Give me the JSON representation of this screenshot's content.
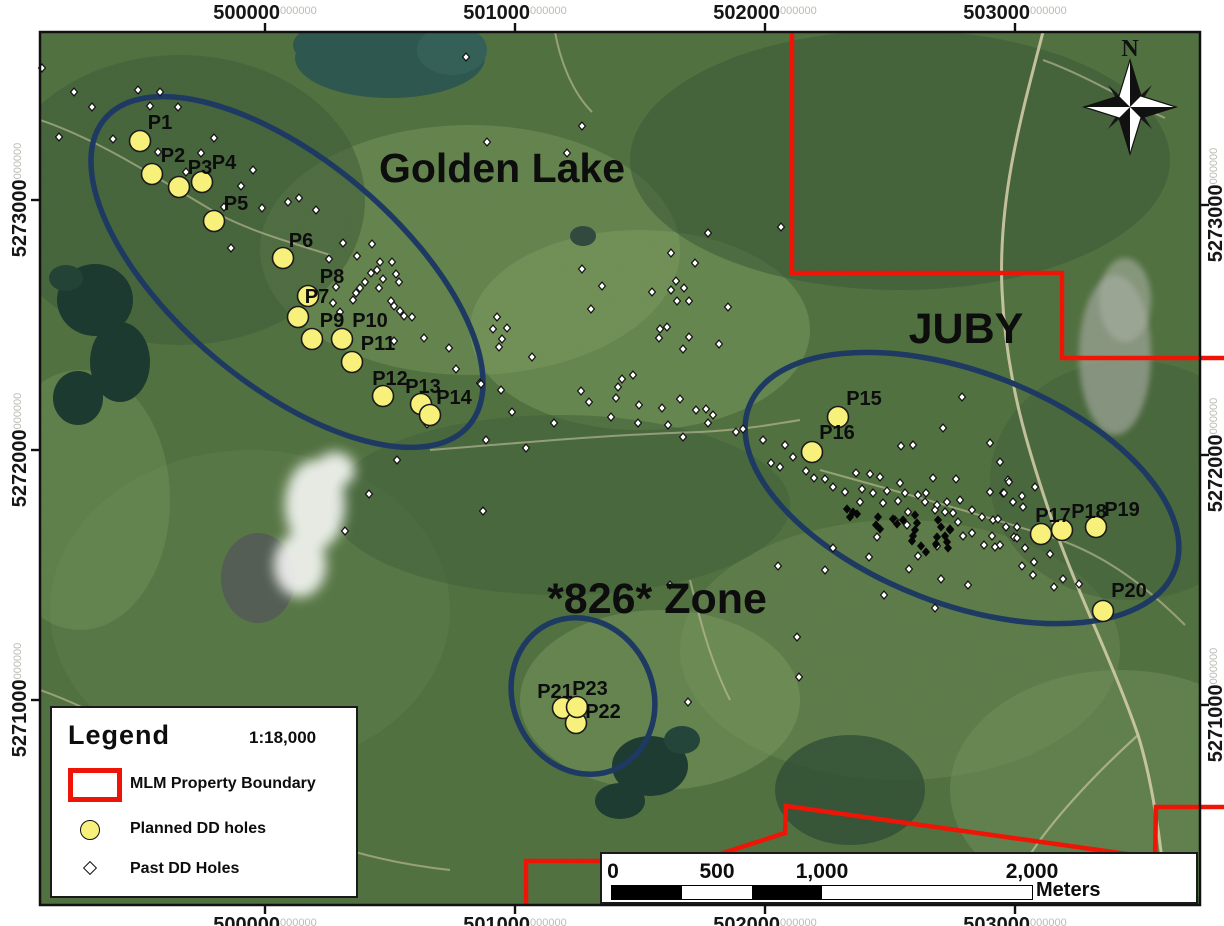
{
  "colors": {
    "boundary_red": "#ee1506",
    "zone_ellipse": "#1e3a62",
    "planned_fill": "#f7f07b",
    "past_fill": "#ffffff",
    "grid_suffix_gray": "#b7bdb2",
    "label_black": "#0d0d0d"
  },
  "north": {
    "label": "N"
  },
  "legend": {
    "title": "Legend",
    "scale": "1:18,000",
    "items": [
      {
        "label": "MLM Property Boundary",
        "type": "boundary"
      },
      {
        "label": "Planned DD holes",
        "type": "planned"
      },
      {
        "label": "Past DD Holes",
        "type": "past"
      }
    ]
  },
  "scalebar": {
    "labels": [
      {
        "t": "0",
        "x": 11
      },
      {
        "t": "500",
        "x": 115
      },
      {
        "t": "1,000",
        "x": 220
      },
      {
        "t": "2,000",
        "x": 430
      }
    ],
    "unit": "Meters",
    "segment_widths": [
      70,
      70,
      70,
      210
    ],
    "segment_colors": [
      "#000000",
      "#ffffff",
      "#000000",
      "#ffffff"
    ]
  },
  "grid": {
    "suffix": "000000",
    "top": [
      {
        "label": "500000",
        "x": 265
      },
      {
        "label": "501000",
        "x": 515
      },
      {
        "label": "502000",
        "x": 765
      },
      {
        "label": "503000",
        "x": 1015
      }
    ],
    "bottom": [
      {
        "label": "500000",
        "x": 265
      },
      {
        "label": "501000",
        "x": 515
      },
      {
        "label": "502000",
        "x": 765
      },
      {
        "label": "503000",
        "x": 1015
      }
    ],
    "left": [
      {
        "label": "5273000",
        "y": 200
      },
      {
        "label": "5272000",
        "y": 450
      },
      {
        "label": "5271000",
        "y": 700
      }
    ],
    "right": [
      {
        "label": "5273000",
        "y": 205
      },
      {
        "label": "5272000",
        "y": 455
      },
      {
        "label": "5271000",
        "y": 705
      }
    ]
  },
  "zones": [
    {
      "name": "Golden Lake",
      "x": 502,
      "y": 182,
      "size": 41,
      "cx": 287,
      "cy": 272,
      "rx": 238,
      "ry": 112,
      "rot": 40
    },
    {
      "name": "JUBY",
      "x": 966,
      "y": 343,
      "size": 43,
      "cx": 962,
      "cy": 488,
      "rx": 228,
      "ry": 116,
      "rot": 21
    },
    {
      "name": "*826* Zone",
      "x": 657,
      "y": 613,
      "size": 43,
      "cx": 583,
      "cy": 696,
      "rx": 70,
      "ry": 80,
      "rot": -25
    }
  ],
  "boundary_paths": [
    "M 792 32 L 792 273 L 1062 273 L 1062 358 L 1224 358",
    "M 526 905 L 526 861 L 698 861 L 785 833 L 786 806 L 1155 858 L 1156 807 L 1224 807"
  ],
  "planned_holes": [
    {
      "id": "P1",
      "x": 140,
      "y": 141,
      "lx": 160,
      "ly": 122
    },
    {
      "id": "P2",
      "x": 152,
      "y": 174,
      "lx": 173,
      "ly": 155
    },
    {
      "id": "P3",
      "x": 179,
      "y": 187,
      "lx": 200,
      "ly": 167
    },
    {
      "id": "P4",
      "x": 202,
      "y": 182,
      "lx": 224,
      "ly": 162
    },
    {
      "id": "P5",
      "x": 214,
      "y": 221,
      "lx": 236,
      "ly": 203
    },
    {
      "id": "P6",
      "x": 283,
      "y": 258,
      "lx": 301,
      "ly": 240
    },
    {
      "id": "P7",
      "x": 308,
      "y": 296,
      "lx": 317,
      "ly": 296
    },
    {
      "id": "P8",
      "x": 298,
      "y": 317,
      "lx": 332,
      "ly": 276
    },
    {
      "id": "P9",
      "x": 312,
      "y": 339,
      "lx": 332,
      "ly": 320
    },
    {
      "id": "P10",
      "x": 342,
      "y": 339,
      "lx": 370,
      "ly": 320
    },
    {
      "id": "P11",
      "x": 352,
      "y": 362,
      "lx": 378,
      "ly": 343
    },
    {
      "id": "P12",
      "x": 383,
      "y": 396,
      "lx": 390,
      "ly": 378
    },
    {
      "id": "P13",
      "x": 421,
      "y": 404,
      "lx": 423,
      "ly": 386
    },
    {
      "id": "P14",
      "x": 430,
      "y": 415,
      "lx": 454,
      "ly": 397
    },
    {
      "id": "P15",
      "x": 838,
      "y": 417,
      "lx": 864,
      "ly": 398
    },
    {
      "id": "P16",
      "x": 812,
      "y": 452,
      "lx": 837,
      "ly": 432
    },
    {
      "id": "P17",
      "x": 1041,
      "y": 534,
      "lx": 1053,
      "ly": 515
    },
    {
      "id": "P18",
      "x": 1062,
      "y": 530,
      "lx": 1089,
      "ly": 511
    },
    {
      "id": "P19",
      "x": 1096,
      "y": 527,
      "lx": 1122,
      "ly": 509
    },
    {
      "id": "P20",
      "x": 1103,
      "y": 611,
      "lx": 1129,
      "ly": 590
    },
    {
      "id": "P21",
      "x": 563,
      "y": 708,
      "lx": 555,
      "ly": 691
    },
    {
      "id": "P22",
      "x": 576,
      "y": 723,
      "lx": 603,
      "ly": 711
    },
    {
      "id": "P23",
      "x": 577,
      "y": 707,
      "lx": 590,
      "ly": 688
    }
  ],
  "past_holes_white": [
    [
      466,
      57
    ],
    [
      42,
      68
    ],
    [
      74,
      92
    ],
    [
      138,
      90
    ],
    [
      160,
      92
    ],
    [
      92,
      107
    ],
    [
      150,
      106
    ],
    [
      178,
      107
    ],
    [
      582,
      126
    ],
    [
      59,
      137
    ],
    [
      113,
      139
    ],
    [
      214,
      138
    ],
    [
      487,
      142
    ],
    [
      158,
      152
    ],
    [
      201,
      153
    ],
    [
      567,
      153
    ],
    [
      253,
      170
    ],
    [
      186,
      172
    ],
    [
      241,
      186
    ],
    [
      288,
      202
    ],
    [
      262,
      208
    ],
    [
      224,
      207
    ],
    [
      299,
      198
    ],
    [
      316,
      210
    ],
    [
      781,
      227
    ],
    [
      231,
      248
    ],
    [
      708,
      233
    ],
    [
      343,
      243
    ],
    [
      372,
      244
    ],
    [
      671,
      253
    ],
    [
      357,
      256
    ],
    [
      329,
      259
    ],
    [
      380,
      262
    ],
    [
      392,
      262
    ],
    [
      695,
      263
    ],
    [
      582,
      269
    ],
    [
      377,
      270
    ],
    [
      371,
      273
    ],
    [
      396,
      274
    ],
    [
      383,
      279
    ],
    [
      676,
      281
    ],
    [
      399,
      282
    ],
    [
      365,
      282
    ],
    [
      602,
      286
    ],
    [
      684,
      288
    ],
    [
      379,
      288
    ],
    [
      360,
      288
    ],
    [
      336,
      287
    ],
    [
      652,
      292
    ],
    [
      356,
      293
    ],
    [
      671,
      290
    ],
    [
      353,
      300
    ],
    [
      391,
      301
    ],
    [
      677,
      301
    ],
    [
      689,
      301
    ],
    [
      333,
      303
    ],
    [
      394,
      306
    ],
    [
      728,
      307
    ],
    [
      591,
      309
    ],
    [
      400,
      311
    ],
    [
      340,
      312
    ],
    [
      404,
      316
    ],
    [
      412,
      317
    ],
    [
      497,
      317
    ],
    [
      493,
      329
    ],
    [
      507,
      328
    ],
    [
      660,
      329
    ],
    [
      667,
      327
    ],
    [
      502,
      339
    ],
    [
      659,
      338
    ],
    [
      689,
      337
    ],
    [
      424,
      338
    ],
    [
      394,
      341
    ],
    [
      719,
      344
    ],
    [
      499,
      347
    ],
    [
      449,
      348
    ],
    [
      683,
      349
    ],
    [
      532,
      357
    ],
    [
      456,
      369
    ],
    [
      622,
      379
    ],
    [
      633,
      375
    ],
    [
      480,
      383
    ],
    [
      481,
      384
    ],
    [
      618,
      387
    ],
    [
      581,
      391
    ],
    [
      501,
      390
    ],
    [
      616,
      398
    ],
    [
      589,
      402
    ],
    [
      680,
      399
    ],
    [
      639,
      405
    ],
    [
      662,
      408
    ],
    [
      706,
      409
    ],
    [
      696,
      410
    ],
    [
      512,
      412
    ],
    [
      713,
      415
    ],
    [
      611,
      417
    ],
    [
      708,
      423
    ],
    [
      638,
      423
    ],
    [
      554,
      423
    ],
    [
      427,
      424
    ],
    [
      668,
      425
    ],
    [
      736,
      432
    ],
    [
      683,
      437
    ],
    [
      486,
      440
    ],
    [
      526,
      448
    ],
    [
      397,
      460
    ],
    [
      369,
      494
    ],
    [
      483,
      511
    ],
    [
      345,
      531
    ],
    [
      962,
      397
    ],
    [
      943,
      428
    ],
    [
      990,
      443
    ],
    [
      743,
      429
    ],
    [
      763,
      440
    ],
    [
      785,
      445
    ],
    [
      771,
      463
    ],
    [
      780,
      467
    ],
    [
      793,
      457
    ],
    [
      806,
      471
    ],
    [
      814,
      478
    ],
    [
      825,
      479
    ],
    [
      833,
      487
    ],
    [
      845,
      492
    ],
    [
      856,
      473
    ],
    [
      870,
      474
    ],
    [
      880,
      477
    ],
    [
      862,
      489
    ],
    [
      873,
      493
    ],
    [
      887,
      491
    ],
    [
      860,
      502
    ],
    [
      883,
      503
    ],
    [
      900,
      483
    ],
    [
      905,
      493
    ],
    [
      898,
      501
    ],
    [
      908,
      512
    ],
    [
      895,
      520
    ],
    [
      907,
      525
    ],
    [
      918,
      495
    ],
    [
      926,
      493
    ],
    [
      925,
      502
    ],
    [
      937,
      505
    ],
    [
      947,
      502
    ],
    [
      935,
      510
    ],
    [
      945,
      512
    ],
    [
      960,
      500
    ],
    [
      972,
      510
    ],
    [
      953,
      513
    ],
    [
      958,
      522
    ],
    [
      950,
      529
    ],
    [
      963,
      536
    ],
    [
      972,
      533
    ],
    [
      982,
      517
    ],
    [
      993,
      520
    ],
    [
      1003,
      493
    ],
    [
      990,
      492
    ],
    [
      1008,
      480
    ],
    [
      1000,
      462
    ],
    [
      933,
      478
    ],
    [
      956,
      479
    ],
    [
      901,
      446
    ],
    [
      913,
      445
    ],
    [
      877,
      537
    ],
    [
      833,
      548
    ],
    [
      869,
      557
    ],
    [
      918,
      556
    ],
    [
      909,
      569
    ],
    [
      937,
      546
    ],
    [
      984,
      545
    ],
    [
      1000,
      545
    ],
    [
      1014,
      537
    ],
    [
      1017,
      527
    ],
    [
      825,
      570
    ],
    [
      884,
      595
    ],
    [
      935,
      608
    ],
    [
      968,
      585
    ],
    [
      941,
      579
    ],
    [
      1009,
      482
    ],
    [
      1004,
      493
    ],
    [
      1022,
      496
    ],
    [
      1013,
      502
    ],
    [
      1023,
      507
    ],
    [
      998,
      519
    ],
    [
      1006,
      527
    ],
    [
      1017,
      538
    ],
    [
      992,
      536
    ],
    [
      995,
      547
    ],
    [
      1025,
      548
    ],
    [
      1035,
      487
    ],
    [
      1050,
      554
    ],
    [
      1034,
      562
    ],
    [
      1022,
      566
    ],
    [
      1033,
      575
    ],
    [
      1054,
      587
    ],
    [
      1063,
      579
    ],
    [
      1079,
      584
    ],
    [
      797,
      637
    ],
    [
      670,
      585
    ],
    [
      778,
      566
    ],
    [
      799,
      677
    ],
    [
      688,
      702
    ]
  ],
  "past_holes_black": [
    [
      847,
      509
    ],
    [
      853,
      512
    ],
    [
      850,
      517
    ],
    [
      857,
      514
    ],
    [
      878,
      517
    ],
    [
      876,
      525
    ],
    [
      880,
      529
    ],
    [
      893,
      519
    ],
    [
      897,
      524
    ],
    [
      903,
      520
    ],
    [
      915,
      515
    ],
    [
      917,
      523
    ],
    [
      915,
      530
    ],
    [
      913,
      536
    ],
    [
      912,
      541
    ],
    [
      938,
      520
    ],
    [
      941,
      527
    ],
    [
      937,
      537
    ],
    [
      936,
      544
    ],
    [
      945,
      536
    ],
    [
      947,
      542
    ],
    [
      948,
      548
    ],
    [
      950,
      530
    ],
    [
      921,
      546
    ],
    [
      926,
      552
    ]
  ]
}
